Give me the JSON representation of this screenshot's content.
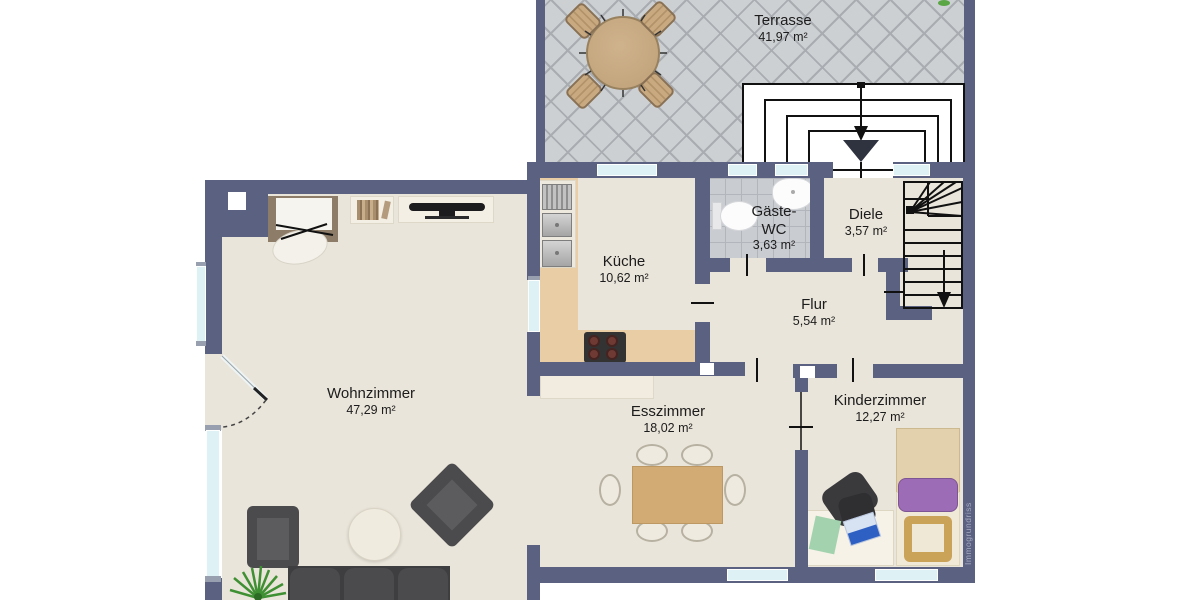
{
  "plan": {
    "title": "floor-plan",
    "watermark": "Immogrundriss",
    "rooms": [
      {
        "name": "Terrasse",
        "area": "41,97 m²"
      },
      {
        "name": "Küche",
        "area": "10,62 m²"
      },
      {
        "name": "Gäste-WC",
        "area": "3,63 m²"
      },
      {
        "name": "Diele",
        "area": "3,57 m²"
      },
      {
        "name": "Flur",
        "area": "5,54 m²"
      },
      {
        "name": "Wohnzimmer",
        "area": "47,29 m²"
      },
      {
        "name": "Esszimmer",
        "area": "18,02 m²"
      },
      {
        "name": "Kinderzimmer",
        "area": "12,27 m²"
      }
    ],
    "colors": {
      "wall": "#5b6181",
      "floor": "#eae5da",
      "window": "#def1f5",
      "terrace_tile": "#cdd0d2",
      "wood": "#d2ab74",
      "accent_purple": "#9c6db6"
    }
  }
}
